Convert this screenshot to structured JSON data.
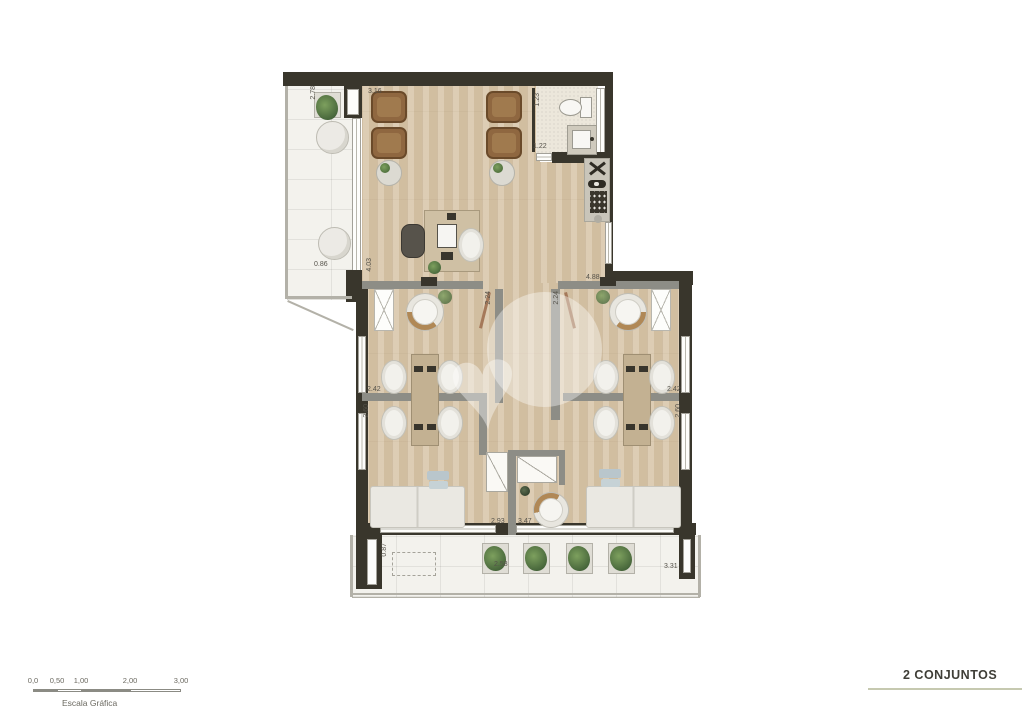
{
  "footer": {
    "title": "2 CONJUNTOS",
    "scale": {
      "label": "Escala Gráfica",
      "ticks": [
        "0,0",
        "0,50",
        "1,00",
        "2,00",
        "3,00"
      ]
    }
  },
  "dimensions": {
    "reception_width_top": "3.16",
    "balcony_top_depth": "2.78",
    "bath_width": "1.23",
    "bath_door": "1.22",
    "balcony_top_width": "0.86",
    "reception_depth_left": "4.03",
    "offices_width_top": "4.88",
    "entry_left": "2.24",
    "entry_right": "2.24",
    "front_room_left": "2.42",
    "front_room_right": "2.42",
    "back_room_left": "2.60",
    "back_room_right": "2.60",
    "closet_width_left": "2.93",
    "closet_width_right": "3.47",
    "balcony_bottom_depth": "0.87",
    "balcony_bottom_width_mid": "2.58",
    "balcony_bottom_width_right": "3.31"
  },
  "icons": {
    "watermark_heart": "♥"
  },
  "colors": {
    "wall": "#39362C",
    "partition": "#8D8D86",
    "wood_floor": "#D9C7AB",
    "upholstery_tan": "#8F6740",
    "title_rule": "#C6C9B0"
  }
}
